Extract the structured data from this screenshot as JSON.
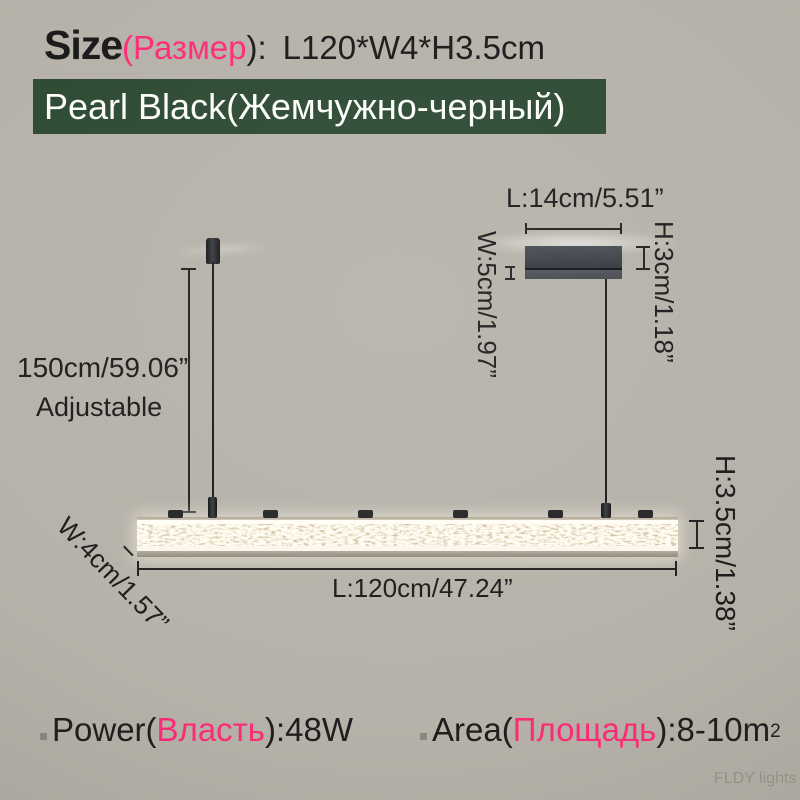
{
  "title": {
    "label": "Size",
    "ru": "(Размер",
    "close": "):",
    "value": "L120*W4*H3.5cm"
  },
  "banner": {
    "text": "Pearl Black(Жемчужно-черный)"
  },
  "dimensions": {
    "canopy_length": "L:14cm/5.51”",
    "canopy_width": "W:5cm/1.97”",
    "canopy_height": "H:3cm/1.18”",
    "drop_length": "150cm/59.06”",
    "drop_note": "Adjustable",
    "bar_length": "L:120cm/47.24”",
    "bar_width": "W:4cm/1.57”",
    "bar_height": "H:3.5cm/1.38”"
  },
  "specs": {
    "power": {
      "label": "Power",
      "open": "(",
      "ru": "Власть",
      "close": "):",
      "value": " 48W"
    },
    "area": {
      "label": "Area",
      "open": "(",
      "ru": "Площадь",
      "close": "):",
      "value": " 8-10m",
      "sup": "2"
    }
  },
  "watermark": "FLDY lights",
  "colors": {
    "background": "#b6b2a9",
    "banner_green": "#2d4a33",
    "accent_pink": "#ff2b77",
    "canopy_gray": "#3a3f46"
  }
}
